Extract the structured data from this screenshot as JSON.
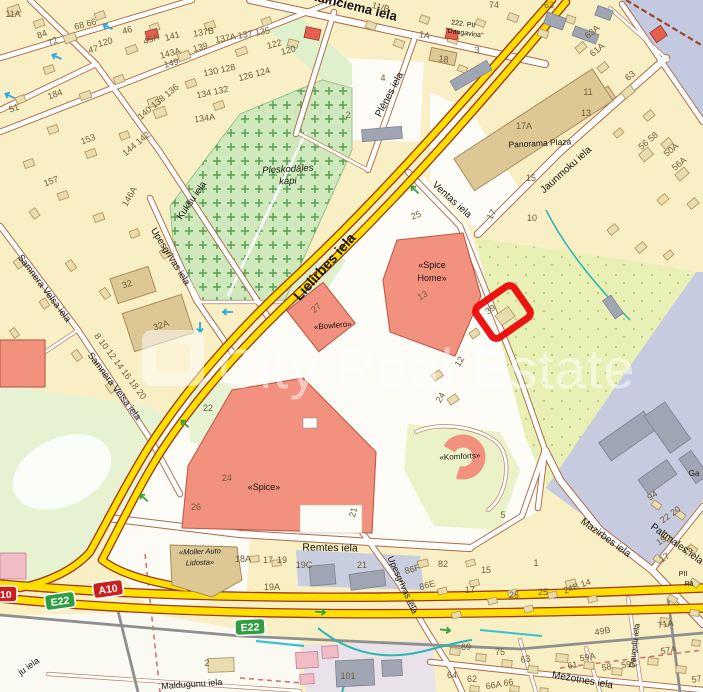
{
  "map_title": "Riga street map — Lielirbes iela / Spice area with highlighted property plot",
  "colors": {
    "background": "#f9efc4",
    "road_minor_casing": "#ad6a49",
    "road_major_fill": "#ffdf00",
    "road_major_casing": "#9c3a1c",
    "cemetery_green": "#cfe9bc",
    "park_green": "#e6f2d2",
    "meadow_green": "#e9f0b6",
    "industrial_lavender": "#c6cbdf",
    "water": "#c3c9de",
    "building_tan": "#e9dcae",
    "building_commercial": "#f2917e",
    "highlight_red": "#ee0000",
    "stream_teal": "#2ab4b4",
    "shield_motorway": "#cc2020",
    "shield_euroroute": "#2e9e40"
  },
  "watermark": {
    "text": "City Real Estate"
  },
  "highlight": {
    "label": "property-plot-outline",
    "plot_number": "39"
  },
  "shields": [
    {
      "l": "A10",
      "style": "motorway",
      "x": 108,
      "y": 589,
      "r": -8
    },
    {
      "l": "A10",
      "style": "motorway",
      "x": 2,
      "y": 594,
      "r": 0
    },
    {
      "l": "E22",
      "style": "euroroute",
      "x": 60,
      "y": 601,
      "r": -8
    },
    {
      "l": "E22",
      "style": "euroroute",
      "x": 250,
      "y": 627,
      "r": -3
    }
  ],
  "street_labels": [
    {
      "t": "Kalnciema iela",
      "x": 352,
      "y": 10,
      "r": 14,
      "s": 13,
      "b": 1
    },
    {
      "t": "Lielirbes iela",
      "x": 328,
      "y": 270,
      "r": -48,
      "s": 14,
      "b": 1
    },
    {
      "t": "Plēnes iela",
      "x": 392,
      "y": 96,
      "r": -62,
      "s": 10
    },
    {
      "t": "Ventas iela",
      "x": 450,
      "y": 202,
      "r": 42,
      "s": 10
    },
    {
      "t": "Jaunmoku iela",
      "x": 568,
      "y": 172,
      "r": -42,
      "s": 10
    },
    {
      "t": "Kukšu iela",
      "x": 194,
      "y": 202,
      "r": -55,
      "s": 9.5
    },
    {
      "t": "Upesgrīvas iela",
      "x": 168,
      "y": 258,
      "r": 58,
      "s": 9.5
    },
    {
      "t": "Samnera Velsa iela",
      "x": 42,
      "y": 290,
      "r": 53,
      "s": 9.5
    },
    {
      "t": "Samnera Velsa iela",
      "x": 112,
      "y": 388,
      "r": 53,
      "s": 9.5
    },
    {
      "t": "Remtes iela",
      "x": 330,
      "y": 551,
      "r": 1,
      "s": 10.5
    },
    {
      "t": "Upesgrīvas iela",
      "x": 400,
      "y": 586,
      "r": 66,
      "s": 9
    },
    {
      "t": "Mazirbes iela",
      "x": 604,
      "y": 540,
      "r": 36,
      "s": 10
    },
    {
      "t": "Paltmales iela",
      "x": 650,
      "y": 528,
      "r": 36,
      "s": 10,
      "a": "start"
    },
    {
      "t": "Mežotnes iela",
      "x": 582,
      "y": 683,
      "r": 10,
      "s": 10
    },
    {
      "t": "Maldugunu iela",
      "x": 192,
      "y": 687,
      "r": -4,
      "s": 9
    },
    {
      "t": "Dauguļu iela",
      "x": 637,
      "y": 646,
      "r": -83,
      "s": 8
    },
    {
      "t": "ju iela",
      "x": 40,
      "y": 662,
      "r": -35,
      "s": 9,
      "a": "end"
    }
  ],
  "place_labels": [
    {
      "t": "Panorama Plaza",
      "x": 540,
      "y": 146,
      "r": -3,
      "s": 8.5,
      "c": "#4a4a4a"
    },
    {
      "t": "222. PII",
      "x": 463,
      "y": 26,
      "r": 8,
      "s": 7,
      "c": "#4a4a4a"
    },
    {
      "t": "\"Daugaviņa\"",
      "x": 464,
      "y": 35,
      "r": 8,
      "s": 7,
      "c": "#4a4a4a"
    },
    {
      "t": "Pleskodāles",
      "x": 288,
      "y": 172,
      "r": -3,
      "s": 9.5,
      "i": 1,
      "c": "#4e5e4a"
    },
    {
      "t": "kapi",
      "x": 288,
      "y": 184,
      "r": -3,
      "s": 9.5,
      "i": 1,
      "c": "#4e5e4a"
    },
    {
      "t": "«Spice",
      "x": 432,
      "y": 268,
      "r": 0,
      "s": 9,
      "c": "#333333"
    },
    {
      "t": "Home»",
      "x": 432,
      "y": 281,
      "r": 0,
      "s": 9,
      "c": "#333333"
    },
    {
      "t": "«Bowlero»",
      "x": 333,
      "y": 328,
      "r": -5,
      "s": 8,
      "c": "#333333"
    },
    {
      "t": "«Spice»",
      "x": 264,
      "y": 490,
      "r": 0,
      "s": 9,
      "c": "#333333"
    },
    {
      "t": "«Komforts»",
      "x": 460,
      "y": 459,
      "r": -3,
      "s": 8,
      "c": "#333333"
    },
    {
      "t": "«Moller Auto",
      "x": 200,
      "y": 554,
      "r": -2,
      "s": 7.5,
      "i": 1,
      "c": "#444444"
    },
    {
      "t": "Lidosta»",
      "x": 200,
      "y": 565,
      "r": -2,
      "s": 7.5,
      "i": 1,
      "c": "#444444"
    },
    {
      "t": "Ga",
      "x": 694,
      "y": 476,
      "r": 0,
      "s": 8,
      "c": "#4a4a4a"
    },
    {
      "t": "PII",
      "x": 683,
      "y": 576,
      "r": 0,
      "s": 7,
      "c": "#4a4a4a"
    },
    {
      "t": "Rā",
      "x": 689,
      "y": 586,
      "r": 0,
      "s": 7,
      "c": "#4a4a4a"
    }
  ],
  "house_numbers": [
    {
      "t": "11A",
      "x": 13,
      "y": 17,
      "r": 0
    },
    {
      "t": "84",
      "x": 43,
      "y": 37,
      "r": -20
    },
    {
      "t": "72",
      "x": 54,
      "y": 44,
      "r": -25
    },
    {
      "t": "68 66",
      "x": 86,
      "y": 27,
      "r": -15
    },
    {
      "t": "46",
      "x": 128,
      "y": 33,
      "r": -15
    },
    {
      "t": "45A",
      "x": 152,
      "y": 42,
      "r": -20
    },
    {
      "t": "47",
      "x": 94,
      "y": 52,
      "r": -15
    },
    {
      "t": "120",
      "x": 106,
      "y": 45,
      "r": -15
    },
    {
      "t": "141",
      "x": 173,
      "y": 39,
      "r": -15
    },
    {
      "t": "143A",
      "x": 171,
      "y": 56,
      "r": -15
    },
    {
      "t": "149",
      "x": 172,
      "y": 66,
      "r": -15
    },
    {
      "t": "139",
      "x": 201,
      "y": 50,
      "r": -15
    },
    {
      "t": "137B",
      "x": 204,
      "y": 35,
      "r": -10
    },
    {
      "t": "137A 137 135",
      "x": 243,
      "y": 38,
      "r": -10
    },
    {
      "t": "130 128",
      "x": 220,
      "y": 73,
      "r": -12
    },
    {
      "t": "126 124",
      "x": 255,
      "y": 77,
      "r": -15
    },
    {
      "t": "122",
      "x": 275,
      "y": 47,
      "r": -15
    },
    {
      "t": "120",
      "x": 289,
      "y": 53,
      "r": -15
    },
    {
      "t": "153",
      "x": 89,
      "y": 142,
      "r": -20
    },
    {
      "t": "157",
      "x": 52,
      "y": 184,
      "r": -20
    },
    {
      "t": "184",
      "x": 56,
      "y": 97,
      "r": -20
    },
    {
      "t": "51",
      "x": 15,
      "y": 111,
      "r": -20
    },
    {
      "t": "146A",
      "x": 132,
      "y": 198,
      "r": -60
    },
    {
      "t": "134A",
      "x": 205,
      "y": 121,
      "r": -8
    },
    {
      "t": "134 132",
      "x": 213,
      "y": 95,
      "r": -12
    },
    {
      "t": "140 138 136",
      "x": 160,
      "y": 104,
      "r": -40
    },
    {
      "t": "144 142",
      "x": 138,
      "y": 146,
      "r": -40
    },
    {
      "t": "8 10 12 14 16 18 20",
      "x": 118,
      "y": 368,
      "r": 53
    },
    {
      "t": "2",
      "x": 348,
      "y": 118,
      "r": 0
    },
    {
      "t": "11/B",
      "x": 380,
      "y": 10,
      "r": 15
    },
    {
      "t": "74",
      "x": 494,
      "y": 8,
      "r": 0
    },
    {
      "t": "63",
      "x": 549,
      "y": 8,
      "r": 0
    },
    {
      "t": "1A",
      "x": 424,
      "y": 38,
      "r": 10
    },
    {
      "t": "18",
      "x": 443,
      "y": 62,
      "r": 10
    },
    {
      "t": "3",
      "x": 477,
      "y": 53,
      "r": 0
    },
    {
      "t": "4",
      "x": 383,
      "y": 81,
      "r": 0
    },
    {
      "t": "63A",
      "x": 594,
      "y": 34,
      "r": -40
    },
    {
      "t": "61A",
      "x": 599,
      "y": 52,
      "r": -40
    },
    {
      "t": "63",
      "x": 632,
      "y": 78,
      "r": -40
    },
    {
      "t": "11",
      "x": 588,
      "y": 95,
      "r": 0
    },
    {
      "t": "13",
      "x": 586,
      "y": 116,
      "r": 0
    },
    {
      "t": "17A",
      "x": 524,
      "y": 129,
      "r": 0
    },
    {
      "t": "15",
      "x": 531,
      "y": 181,
      "r": 0
    },
    {
      "t": "17",
      "x": 494,
      "y": 216,
      "r": -60
    },
    {
      "t": "10",
      "x": 532,
      "y": 221,
      "r": 0
    },
    {
      "t": "25",
      "x": 417,
      "y": 218,
      "r": -20
    },
    {
      "t": "56 58",
      "x": 650,
      "y": 143,
      "r": -40
    },
    {
      "t": "50A",
      "x": 673,
      "y": 152,
      "r": -40
    },
    {
      "t": "56A",
      "x": 681,
      "y": 166,
      "r": -40
    },
    {
      "t": "39",
      "x": 492,
      "y": 312,
      "r": -35
    },
    {
      "t": "12",
      "x": 462,
      "y": 363,
      "r": -60
    },
    {
      "t": "24",
      "x": 443,
      "y": 399,
      "r": -60
    },
    {
      "t": "32",
      "x": 128,
      "y": 287,
      "r": -18
    },
    {
      "t": "32A",
      "x": 162,
      "y": 328,
      "r": -18
    },
    {
      "t": "22",
      "x": 208,
      "y": 411,
      "r": 0
    },
    {
      "t": "13",
      "x": 424,
      "y": 298,
      "r": -30
    },
    {
      "t": "27",
      "x": 318,
      "y": 310,
      "r": -40
    },
    {
      "t": "24",
      "x": 227,
      "y": 481,
      "r": 0
    },
    {
      "t": "26",
      "x": 196,
      "y": 510,
      "r": 0
    },
    {
      "t": "21",
      "x": 356,
      "y": 513,
      "r": -75
    },
    {
      "t": "5",
      "x": 503,
      "y": 518,
      "r": 0
    },
    {
      "t": "1",
      "x": 536,
      "y": 566,
      "r": 0
    },
    {
      "t": "86F",
      "x": 413,
      "y": 572,
      "r": -15
    },
    {
      "t": "86E",
      "x": 428,
      "y": 588,
      "r": -15
    },
    {
      "t": "82",
      "x": 443,
      "y": 567,
      "r": 0
    },
    {
      "t": "15",
      "x": 486,
      "y": 573,
      "r": 0
    },
    {
      "t": "17",
      "x": 470,
      "y": 593,
      "r": 0
    },
    {
      "t": "25",
      "x": 514,
      "y": 598,
      "r": 0
    },
    {
      "t": "25",
      "x": 543,
      "y": 595,
      "r": 0
    },
    {
      "t": "24B 14",
      "x": 578,
      "y": 589,
      "r": -20
    },
    {
      "t": "71A",
      "x": 666,
      "y": 627,
      "r": -10
    },
    {
      "t": "49B",
      "x": 603,
      "y": 634,
      "r": -10
    },
    {
      "t": "57A",
      "x": 669,
      "y": 653,
      "r": -10
    },
    {
      "t": "59A",
      "x": 588,
      "y": 660,
      "r": -10
    },
    {
      "t": "58",
      "x": 607,
      "y": 670,
      "r": -10
    },
    {
      "t": "59C",
      "x": 630,
      "y": 667,
      "r": -10
    },
    {
      "t": "61",
      "x": 573,
      "y": 668,
      "r": -10
    },
    {
      "t": "63",
      "x": 526,
      "y": 662,
      "r": -10
    },
    {
      "t": "75",
      "x": 500,
      "y": 655,
      "r": 0
    },
    {
      "t": "69",
      "x": 466,
      "y": 650,
      "r": 0
    },
    {
      "t": "64",
      "x": 452,
      "y": 678,
      "r": 0
    },
    {
      "t": "62",
      "x": 472,
      "y": 682,
      "r": 0
    },
    {
      "t": "66A 66",
      "x": 500,
      "y": 687,
      "r": -10
    },
    {
      "t": "57",
      "x": 697,
      "y": 682,
      "r": -10
    },
    {
      "t": "101",
      "x": 348,
      "y": 679,
      "r": 0
    },
    {
      "t": "2",
      "x": 207,
      "y": 666,
      "r": 0
    },
    {
      "t": "19C",
      "x": 304,
      "y": 568,
      "r": 0
    },
    {
      "t": "18A",
      "x": 243,
      "y": 562,
      "r": 0
    },
    {
      "t": "17",
      "x": 268,
      "y": 563,
      "r": 0
    },
    {
      "t": "19",
      "x": 282,
      "y": 563,
      "r": 0
    },
    {
      "t": "19A",
      "x": 272,
      "y": 590,
      "r": 0
    },
    {
      "t": "21",
      "x": 362,
      "y": 568,
      "r": 0
    },
    {
      "t": "94",
      "x": 654,
      "y": 498,
      "r": -35
    },
    {
      "t": "22 20",
      "x": 672,
      "y": 517,
      "r": -35
    },
    {
      "t": "19",
      "x": 663,
      "y": 543,
      "r": -35
    },
    {
      "t": "17",
      "x": 666,
      "y": 560,
      "r": -35
    },
    {
      "t": "15",
      "x": 689,
      "y": 553,
      "r": -35
    }
  ]
}
